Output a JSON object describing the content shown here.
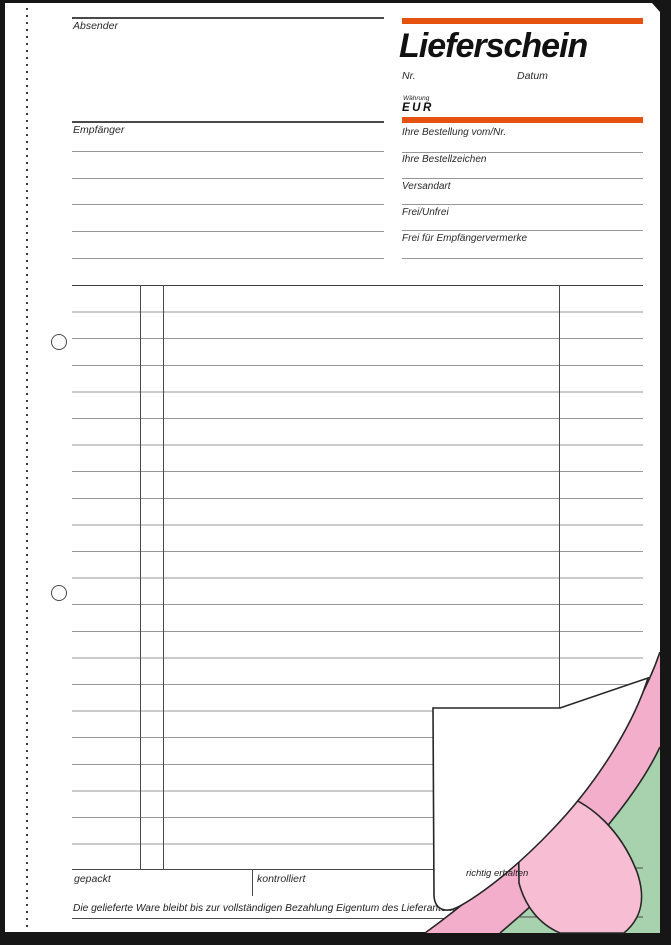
{
  "form": {
    "title": "Lieferschein",
    "sender": {
      "label": "Absender"
    },
    "recipient": {
      "label": "Empfänger"
    },
    "number_label": "Nr.",
    "date_label": "Datum",
    "currency_caption": "Währung",
    "currency_value": "EUR",
    "order_fields": [
      {
        "label": "Ihre Bestellung vom/Nr."
      },
      {
        "label": "Ihre Bestellzeichen"
      },
      {
        "label": "Versandart"
      },
      {
        "label": "Frei/Unfrei"
      },
      {
        "label": "Frei für Empfängervermerke"
      }
    ],
    "signature_row": {
      "packed_label": "gepackt",
      "checked_label": "kontrolliert",
      "received_label": "richtig erhalten"
    },
    "footer_note": "Die gelieferte Ware bleibt bis zur vollständigen Bezahlung Eigentum des Lieferanten.",
    "colors": {
      "accent_bar": "#E5520F",
      "copy_sheet_pink": "#F3AECB",
      "copy_sheet_pink_back": "#F6BDD3",
      "copy_sheet_green": "#A8D2AE"
    }
  }
}
